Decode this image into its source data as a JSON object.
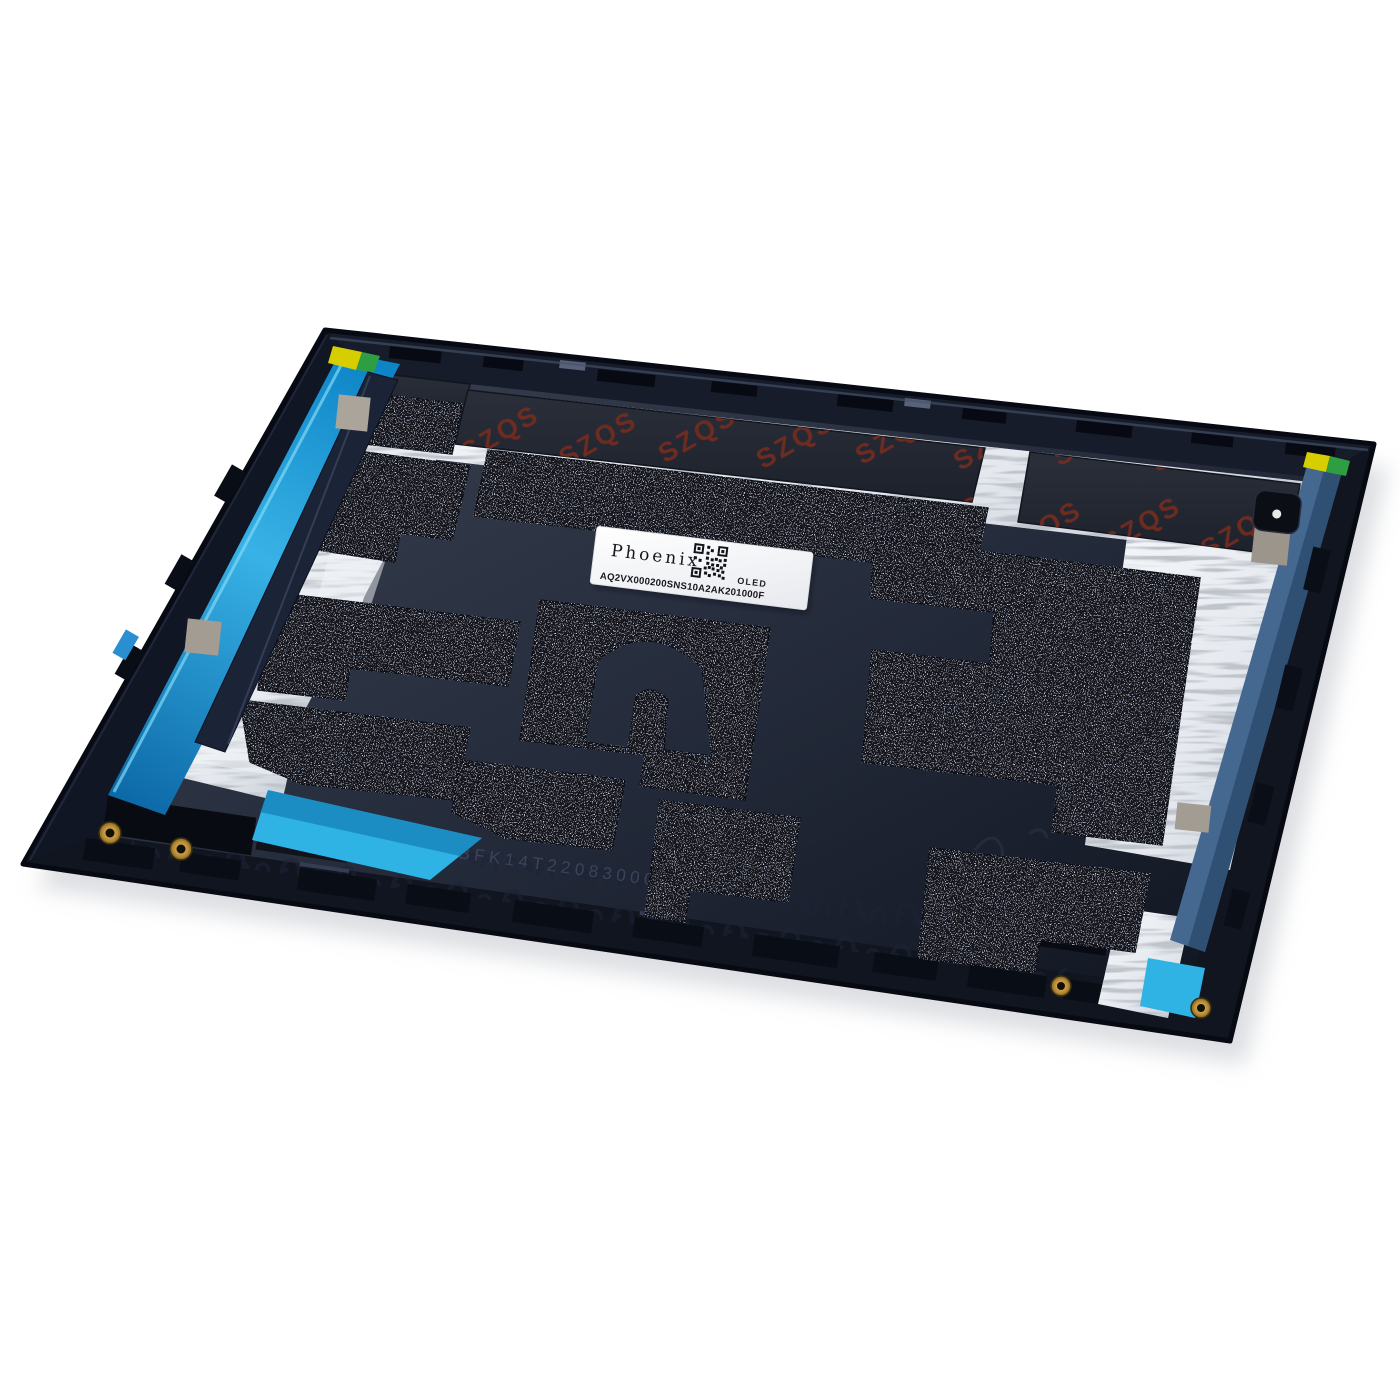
{
  "scene": {
    "type": "product-photo",
    "subject": "Laptop display back cover replacement part, inner side, tilted on white background",
    "background_color": "#ffffff"
  },
  "part": {
    "colors": {
      "body_navy": "#131927",
      "surface_slate": "#2c3342",
      "foam_black": "#16191f",
      "foil_silver": "#eef1f5",
      "tape_left_blue": "#28a9e0",
      "tape_right_steel": "#44688f",
      "tape_fold_cyan": "#2fb2e4",
      "marker_yellow": "#d6ce00",
      "marker_green": "#2f9e43",
      "watermark_red": "#7b2c1c",
      "brass_gold": "#bb913d"
    }
  },
  "label": {
    "brand": "Phoenix",
    "panel_type": "OLED",
    "serial": "AQ2VX000200SNS10A2AK201000F"
  },
  "markings": {
    "foam_watermark": "SZQS",
    "etched_serial": "BFK14T22083000148"
  }
}
